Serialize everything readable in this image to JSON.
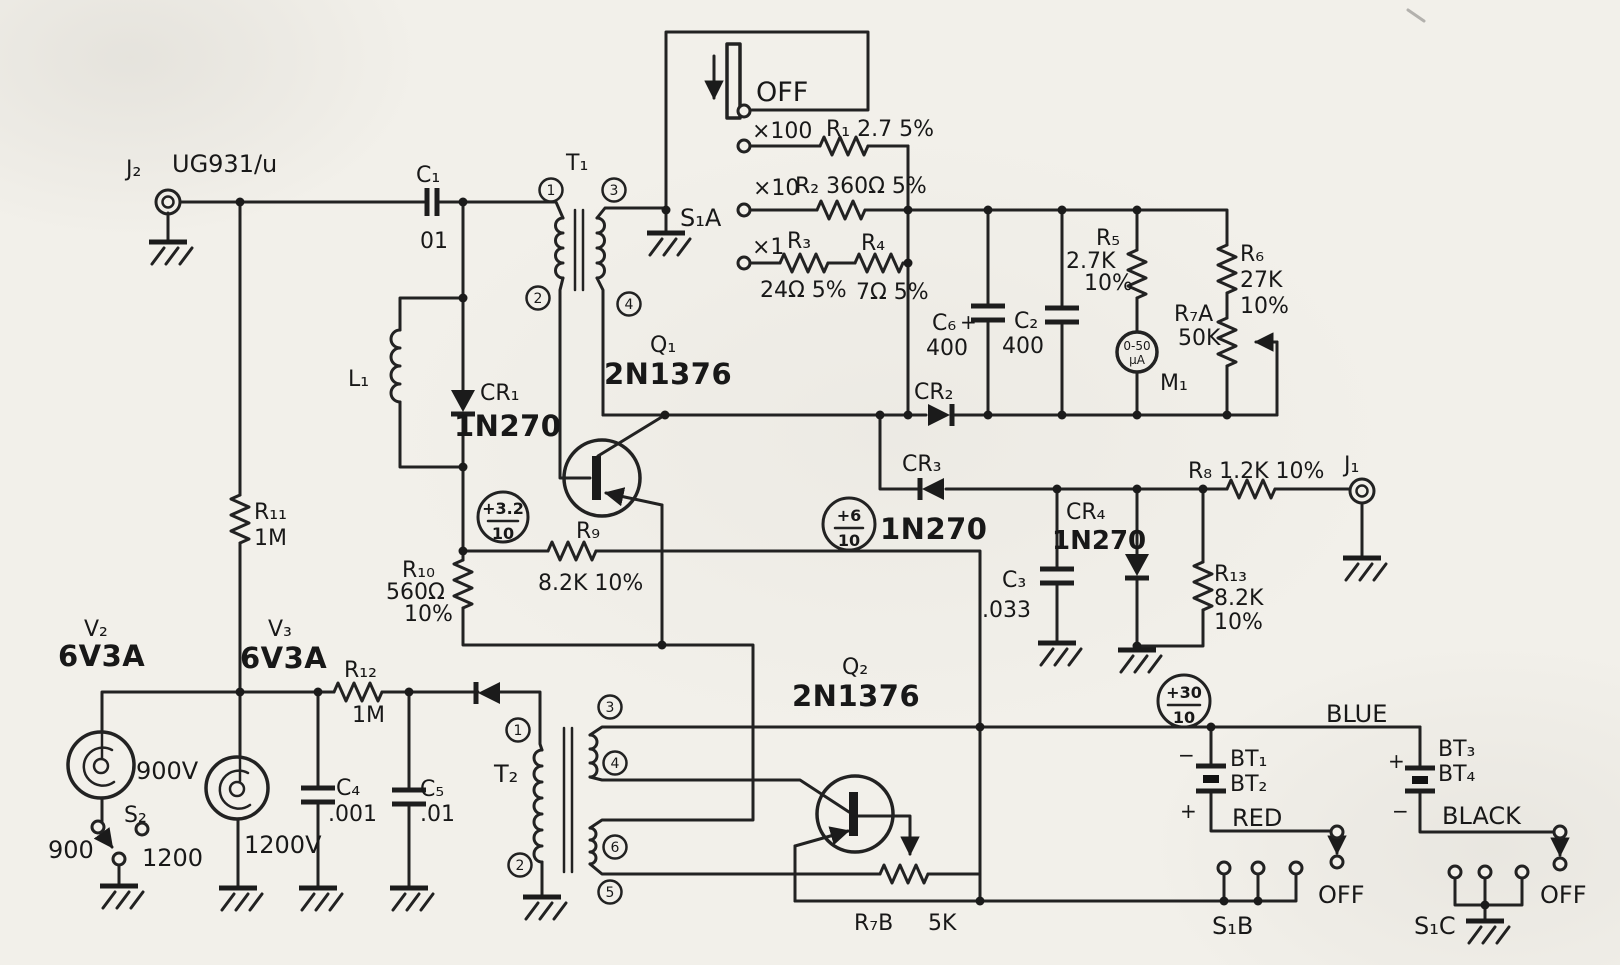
{
  "sch": {
    "input": {
      "j2": "J₂",
      "j2_type": "UG931/u",
      "c1": "C₁",
      "c1_v": "01",
      "l1": "L₁",
      "cr1": "CR₁",
      "cr1_t": "1N270",
      "r11": "R₁₁",
      "r11_v": "1M"
    },
    "t1": {
      "ref": "T₁",
      "p1": "1",
      "p2": "2",
      "p3": "3",
      "p4": "4"
    },
    "s1a": {
      "ref": "S₁A",
      "off": "OFF",
      "x100": "×100",
      "x10": "×10",
      "x1": "×1",
      "r1": "R₁ 2.7 5%",
      "r2": "R₂ 360Ω 5%",
      "r3": "R₃",
      "r3_v": "24Ω 5%",
      "r4": "R₄",
      "r4_v": "7Ω 5%"
    },
    "det": {
      "c6": "C₆",
      "c6_v": "400",
      "plus": "+",
      "c2": "C₂",
      "c2_v": "400",
      "r5": "R₅",
      "r5_v": "2.7K",
      "r5_t": "10%",
      "m1": "M₁",
      "m1_f1": "0-50",
      "m1_f2": "µA",
      "r6": "R₆",
      "r6_v": "27K",
      "r6_t": "10%",
      "r7a": "R₇A",
      "r7a_v": "50K",
      "cr2": "CR₂",
      "cr3": "CR₃",
      "cr3_t": "1N270",
      "cr4": "CR₄",
      "cr4_t": "1N270",
      "c3": "C₃",
      "c3_v": ".033",
      "r8": "R₈ 1.2K 10%",
      "j1": "J₁",
      "r13": "R₁₃",
      "r13_v": "8.2K",
      "r13_t": "10%"
    },
    "osc1": {
      "q1": "Q₁",
      "q1_t": "2N1376",
      "r9": "R₉",
      "r9_v": "8.2K 10%",
      "r10": "R₁₀",
      "r10_v": "560Ω",
      "r10_t": "10%"
    },
    "tp": {
      "tp1": "+3.2",
      "tp2": "+6",
      "tp3": "+30",
      "den": "10"
    },
    "heater": {
      "v2": "V₂",
      "v2_t": "6V3A",
      "v2_v": "900V",
      "v3": "V₃",
      "v3_t": "6V3A",
      "v3_v": "1200V",
      "s2": "S₂",
      "p900": "900",
      "p1200": "1200",
      "r12": "R₁₂",
      "r12_v": "1M",
      "c4": "C₄",
      "c4_v": ".001",
      "c5": "C₅",
      "c5_v": ".01"
    },
    "t2": {
      "ref": "T₂",
      "p1": "1",
      "p2": "2",
      "p3": "3",
      "p4": "4",
      "p5": "5",
      "p6": "6"
    },
    "osc2": {
      "q2": "Q₂",
      "q2_t": "2N1376",
      "r7b": "R₇B",
      "r7b_v": "5K"
    },
    "power": {
      "bt1": "BT₁",
      "bt2": "BT₂",
      "bt3": "BT₃",
      "bt4": "BT₄",
      "blue": "BLUE",
      "red": "RED",
      "black": "BLACK",
      "plus": "+",
      "minus": "−",
      "s1b": "S₁B",
      "s1c": "S₁C",
      "off": "OFF"
    }
  }
}
